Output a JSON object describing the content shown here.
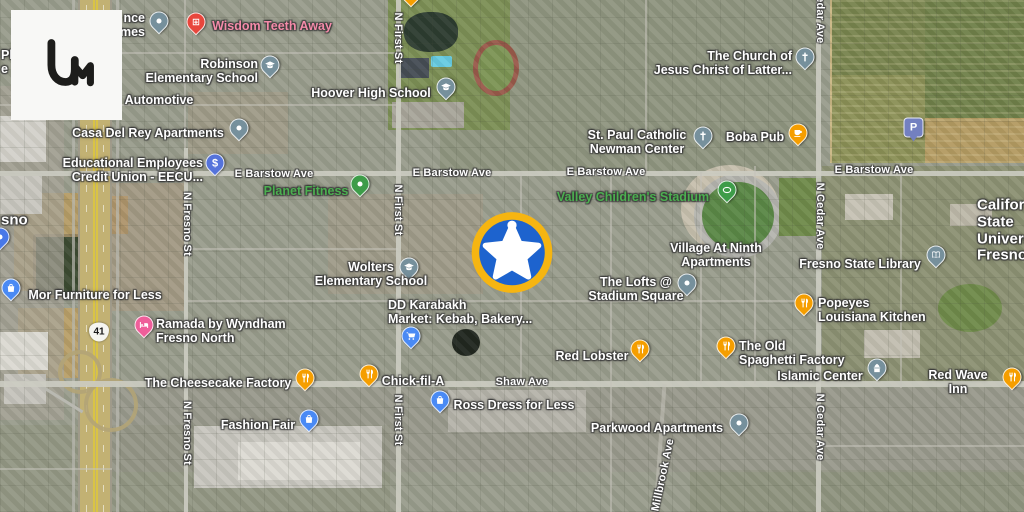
{
  "app": {
    "logo": {
      "name": "liveuamap-um-logo",
      "bg": "#F8F8F6",
      "glyph_color": "#1D1D1B"
    }
  },
  "map": {
    "type": "satellite",
    "event_marker": {
      "name": "sheriff-star-event-marker",
      "x": 512,
      "y": 255,
      "ring": "#F6B511",
      "fill": "#1D63CE",
      "star": "#FFFFFF"
    },
    "highway_shield": {
      "number": "41",
      "x": 99,
      "y": 332
    },
    "label_colors": {
      "default": "#FFFFFF",
      "park_green": "#4CAF50",
      "health_pink": "#F48BA9"
    },
    "streets": [
      {
        "label": "E Barstow Ave",
        "x": 274,
        "y": 174,
        "rot": 0
      },
      {
        "label": "E Barstow Ave",
        "x": 452,
        "y": 173,
        "rot": 0
      },
      {
        "label": "E Barstow Ave",
        "x": 606,
        "y": 172,
        "rot": 0
      },
      {
        "label": "E Barstow Ave",
        "x": 874,
        "y": 170,
        "rot": 0
      },
      {
        "label": "Shaw Ave",
        "x": 522,
        "y": 382,
        "rot": 0
      },
      {
        "label": "N First St",
        "x": 398,
        "y": 38,
        "rot": 90
      },
      {
        "label": "N First St",
        "x": 398,
        "y": 210,
        "rot": 90
      },
      {
        "label": "N First St",
        "x": 398,
        "y": 420,
        "rot": 90
      },
      {
        "label": "N Fresno St",
        "x": 187,
        "y": 224,
        "rot": 90
      },
      {
        "label": "N Fresno St",
        "x": 187,
        "y": 433,
        "rot": 90
      },
      {
        "label": "N Cedar Ave",
        "x": 820,
        "y": 10,
        "rot": 90
      },
      {
        "label": "N Cedar Ave",
        "x": 820,
        "y": 216,
        "rot": 90
      },
      {
        "label": "N Cedar Ave",
        "x": 820,
        "y": 427,
        "rot": 90
      },
      {
        "label": "Millbrook Ave",
        "x": 663,
        "y": 475,
        "rot": -78
      }
    ],
    "pois": [
      {
        "name": "residence-fragment",
        "icon": "dot",
        "pin": "#76909C",
        "mx": 159,
        "my": 21,
        "label": "nce\nmes",
        "lx": 145,
        "ly": 25,
        "align": "right"
      },
      {
        "name": "wisdom-teeth-away",
        "icon": "hospital",
        "pin": "#E8463C",
        "mx": 196,
        "my": 22,
        "label": "Wisdom Teeth Away",
        "lx": 272,
        "ly": 26,
        "align": "center",
        "color": "#F48BA9"
      },
      {
        "name": "robinson-elementary-school",
        "icon": "school",
        "pin": "#76909C",
        "mx": 270,
        "my": 65,
        "label": "Robinson\nElementary School",
        "lx": 258,
        "ly": 71,
        "align": "right"
      },
      {
        "name": "hoover-high-school",
        "icon": "school",
        "pin": "#76909C",
        "mx": 446,
        "my": 87,
        "label": "Hoover High School",
        "lx": 371,
        "ly": 93,
        "align": "center"
      },
      {
        "name": "automotive-fragment",
        "icon": "none",
        "label": "Automotive",
        "lx": 159,
        "ly": 100,
        "align": "center"
      },
      {
        "name": "casa-del-rey-apartments",
        "icon": "dot",
        "pin": "#76909C",
        "mx": 239,
        "my": 128,
        "label": "Casa Del Rey Apartments",
        "lx": 148,
        "ly": 133,
        "align": "center"
      },
      {
        "name": "eecu-credit-union",
        "icon": "bank",
        "pin": "#5573DB",
        "mx": 215,
        "my": 163,
        "label": "Educational Employees\nCredit Union - EECU...",
        "lx": 203,
        "ly": 170,
        "align": "right"
      },
      {
        "name": "planet-fitness",
        "icon": "fitness",
        "pin": "#3E9C49",
        "mx": 360,
        "my": 184,
        "label": "Planet Fitness",
        "lx": 306,
        "ly": 191,
        "align": "center",
        "color": "#4CAF50"
      },
      {
        "name": "church-of-jesus-christ-lds",
        "icon": "church",
        "pin": "#76909C",
        "mx": 805,
        "my": 57,
        "label": "The Church of\nJesus Christ of Latter...",
        "lx": 792,
        "ly": 63,
        "align": "right"
      },
      {
        "name": "st-paul-catholic-newman-center",
        "icon": "church",
        "pin": "#76909C",
        "mx": 703,
        "my": 136,
        "label": "St. Paul Catholic\nNewman Center",
        "lx": 637,
        "ly": 142,
        "align": "center"
      },
      {
        "name": "boba-pub",
        "icon": "cafe",
        "pin": "#F59E00",
        "mx": 798,
        "my": 133,
        "label": "Boba Pub",
        "lx": 755,
        "ly": 137,
        "align": "center"
      },
      {
        "name": "parking",
        "icon": "parking",
        "pin": "#7380C0",
        "mx": 913,
        "my": 127,
        "label": ""
      },
      {
        "name": "valley-childrens-stadium",
        "icon": "stadium",
        "pin": "#3E9C49",
        "mx": 727,
        "my": 190,
        "label": "Valley Children's Stadium",
        "lx": 633,
        "ly": 197,
        "align": "center",
        "color": "#4CAF50"
      },
      {
        "name": "fresno-city-fragment",
        "icon": "none",
        "label": "sno",
        "lx": 1,
        "ly": 221,
        "align": "left",
        "size": 15
      },
      {
        "name": "edge-place-fragment",
        "icon": "none",
        "label": "Pl\ne",
        "lx": 1,
        "ly": 62,
        "align": "left"
      },
      {
        "name": "edge-blue-marker",
        "icon": "dot",
        "pin": "#4878E8",
        "mx": 0,
        "my": 237,
        "label": ""
      },
      {
        "name": "village-at-ninth-apartments",
        "icon": "none",
        "label": "Village At Ninth\nApartments",
        "lx": 716,
        "ly": 255,
        "align": "center"
      },
      {
        "name": "fresno-state-library",
        "icon": "library",
        "pin": "#76909C",
        "mx": 936,
        "my": 255,
        "label": "Fresno State Library",
        "lx": 860,
        "ly": 264,
        "align": "center"
      },
      {
        "name": "california-state-university-fresno",
        "icon": "none",
        "label": "California\nState\nUniversity,\nFresno",
        "lx": 977,
        "ly": 231,
        "align": "left",
        "size": 15
      },
      {
        "name": "wolters-elementary-school",
        "icon": "school",
        "pin": "#76909C",
        "mx": 409,
        "my": 267,
        "label": "Wolters\nElementary School",
        "lx": 371,
        "ly": 274,
        "align": "center"
      },
      {
        "name": "dd-karabakh-market",
        "icon": "none",
        "label": "DD Karabakh\nMarket: Kebab, Bakery...",
        "lx": 388,
        "ly": 312,
        "align": "left"
      },
      {
        "name": "the-lofts-stadium-square",
        "icon": "dot",
        "pin": "#76909C",
        "mx": 687,
        "my": 283,
        "label": "The Lofts @\nStadium Square",
        "lx": 636,
        "ly": 289,
        "align": "center"
      },
      {
        "name": "popeyes-louisiana-kitchen",
        "icon": "food",
        "pin": "#F59E00",
        "mx": 804,
        "my": 303,
        "label": "Popeyes\nLouisiana Kitchen",
        "lx": 818,
        "ly": 310,
        "align": "left"
      },
      {
        "name": "mor-furniture-for-less",
        "icon": "shopping",
        "pin": "#4A8AF4",
        "mx": 11,
        "my": 288,
        "label": "Mor Furniture for Less",
        "lx": 95,
        "ly": 295,
        "align": "center"
      },
      {
        "name": "ramada-by-wyndham-fresno-north",
        "icon": "hotel",
        "pin": "#EF5E9A",
        "mx": 144,
        "my": 325,
        "label": "Ramada by Wyndham\nFresno North",
        "lx": 156,
        "ly": 331,
        "align": "left"
      },
      {
        "name": "grocery-marker",
        "icon": "cart",
        "pin": "#4A8AF4",
        "mx": 411,
        "my": 336,
        "label": ""
      },
      {
        "name": "red-lobster",
        "icon": "food",
        "pin": "#F59E00",
        "mx": 640,
        "my": 349,
        "label": "Red Lobster",
        "lx": 592,
        "ly": 356,
        "align": "center"
      },
      {
        "name": "old-spaghetti-factory",
        "icon": "food",
        "pin": "#F59E00",
        "mx": 726,
        "my": 346,
        "label": "The Old\nSpaghetti Factory",
        "lx": 739,
        "ly": 353,
        "align": "left"
      },
      {
        "name": "cheesecake-factory",
        "icon": "food",
        "pin": "#F59E00",
        "mx": 305,
        "my": 378,
        "label": "The Cheesecake Factory",
        "lx": 218,
        "ly": 383,
        "align": "center"
      },
      {
        "name": "chick-fil-a",
        "icon": "food",
        "pin": "#F59E00",
        "mx": 369,
        "my": 374,
        "label": "Chick-fil-A",
        "lx": 413,
        "ly": 381,
        "align": "center"
      },
      {
        "name": "islamic-center",
        "icon": "mosque",
        "pin": "#76909C",
        "mx": 877,
        "my": 368,
        "label": "Islamic Center",
        "lx": 820,
        "ly": 376,
        "align": "center"
      },
      {
        "name": "red-wave-inn",
        "icon": "food",
        "pin": "#F59E00",
        "mx": 1012,
        "my": 377,
        "label": "Red Wave Inn",
        "lx": 958,
        "ly": 382,
        "align": "center"
      },
      {
        "name": "ross-dress-for-less",
        "icon": "shopping",
        "pin": "#4A8AF4",
        "mx": 440,
        "my": 400,
        "label": "Ross Dress for Less",
        "lx": 514,
        "ly": 405,
        "align": "center"
      },
      {
        "name": "fashion-fair",
        "icon": "shopping",
        "pin": "#4A8AF4",
        "mx": 309,
        "my": 419,
        "label": "Fashion Fair",
        "lx": 258,
        "ly": 425,
        "align": "center"
      },
      {
        "name": "parkwood-apartments",
        "icon": "dot",
        "pin": "#76909C",
        "mx": 739,
        "my": 423,
        "label": "Parkwood Apartments",
        "lx": 657,
        "ly": 428,
        "align": "center"
      },
      {
        "name": "top-edge-cut-marker",
        "icon": "food",
        "pin": "#F59E00",
        "mx": 411,
        "my": -6,
        "label": ""
      }
    ]
  }
}
